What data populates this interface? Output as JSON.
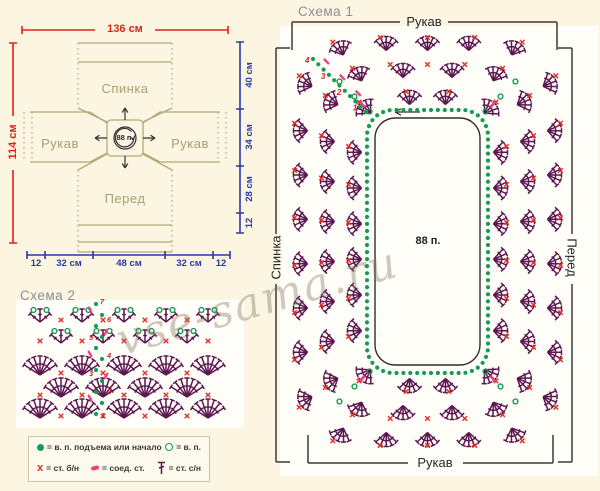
{
  "colors": {
    "fan": "#5c1650",
    "red_x": "#e03028",
    "green": "#169a56",
    "pink": "#ee3f82",
    "tan": "#b3aa7a",
    "measure_red": "#e02118",
    "measure_blue": "#2b38a6",
    "bracket": "#3b3b3b",
    "title": "#8e8d96",
    "background": "#fbf5e2"
  },
  "schematic": {
    "pieces": {
      "back": "Спинка",
      "sleeve": "Рукав",
      "front": "Перед",
      "center": "88 п."
    },
    "measurements": {
      "top": "136 см",
      "left": "114 см",
      "right": [
        "40 см",
        "34 см",
        "28 см",
        "12"
      ],
      "bottom": [
        "12",
        "32 см",
        "48 см",
        "32 см",
        "12"
      ]
    }
  },
  "chart1": {
    "title": "Схема 1",
    "top_label": "Рукав",
    "bottom_label": "Рукав",
    "left_label": "Спинка",
    "right_label": "Перед",
    "center_label": "88 п.",
    "row_numbers": [
      "1",
      "2",
      "3",
      "4"
    ]
  },
  "chart2": {
    "title": "Схема 2",
    "row_numbers": [
      "1",
      "2",
      "3",
      "4",
      "5",
      "6",
      "7"
    ]
  },
  "legend": {
    "row1": [
      {
        "sym": "chain-start",
        "text": "= в. п. подъема или начало"
      },
      {
        "sym": "chain",
        "text": "= в. п."
      }
    ],
    "row2": [
      {
        "sym": "sc",
        "text": "= ст. б/н"
      },
      {
        "sym": "slip",
        "text": "= соед. ст."
      },
      {
        "sym": "dc",
        "text": "= ст. с/н"
      }
    ]
  },
  "watermark": "vse-sama.ru"
}
